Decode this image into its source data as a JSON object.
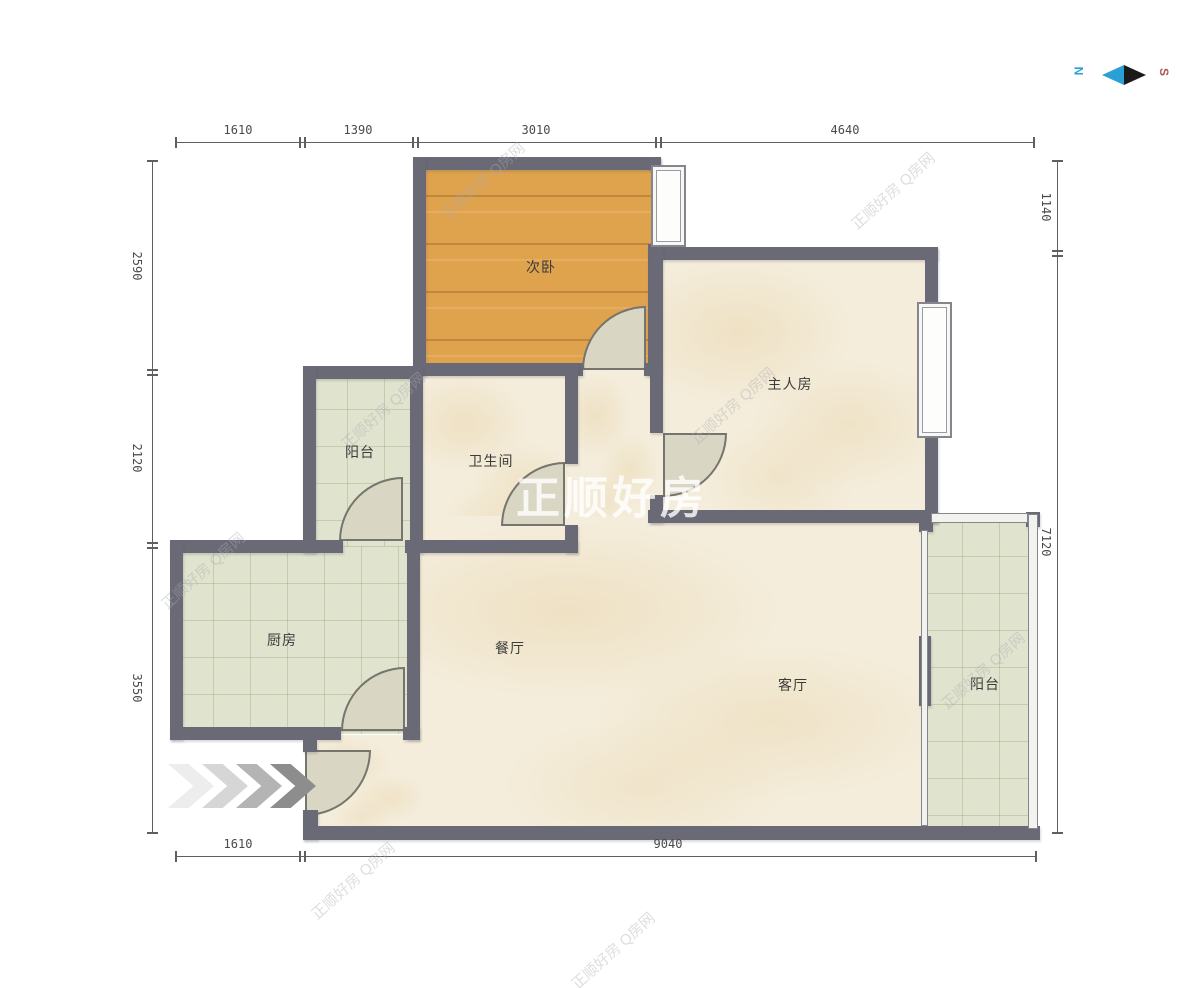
{
  "rooms": {
    "bedroom2": "次卧",
    "master": "主人房",
    "balcony_tl": "阳台",
    "bathroom": "卫生间",
    "kitchen": "厨房",
    "dining": "餐厅",
    "living": "客厅",
    "balcony_r": "阳台"
  },
  "dimensions": {
    "top": [
      "1610",
      "1390",
      "3010",
      "4640"
    ],
    "bottom": [
      "1610",
      "9040"
    ],
    "left": [
      "2590",
      "2120",
      "3550"
    ],
    "right": [
      "1140",
      "7120"
    ]
  },
  "compass": {
    "north": "N",
    "south": "S"
  },
  "watermark": {
    "large": "正顺好房",
    "small": "正顺好房 Q房网"
  },
  "colors": {
    "wall": "#6a6a76",
    "wood_floor": "#dfa24d",
    "tile_floor": "#e0e3cd",
    "marble_floor": "#f4eddb",
    "door": "#dad6c4",
    "compass_north_blue": "#2aa0d6",
    "compass_south_red": "#b0534e"
  }
}
